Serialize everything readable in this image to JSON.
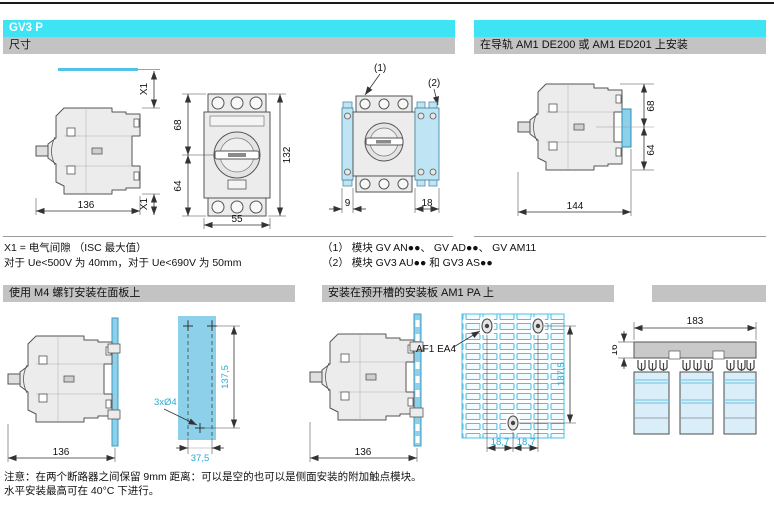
{
  "header": {
    "product": "GV3 P",
    "dim_title": "尺寸",
    "rail_title": "在导轨 AM1 DE200 或 AM1 ED201 上安装"
  },
  "sections": {
    "panel_title": "使用 M4 螺钉安装在面板上",
    "plate_title": "安装在预开槽的安装板 AM1 PA 上"
  },
  "footnotes": {
    "x1_line1": "X1 = 电气间隙 （ISC 最大值）",
    "x1_line2": "对于 Ue<500V 为 40mm，对于 Ue<690V 为 50mm",
    "mod_line1": "（1） 模块 GV AN●●、 GV AD●●、 GV AM11",
    "mod_line2": "（2） 模块 GV3 AU●● 和 GV3 AS●●"
  },
  "notes": {
    "line1": "注意：在两个断路器之间保留 9mm 距离：可以是空的也可以是侧面安装的附加触点模块。",
    "line2": "水平安装最高可在 40°C 下进行。"
  },
  "dims": {
    "side": {
      "x1_top": "X1",
      "x1_bottom": "X1",
      "width": "136"
    },
    "front": {
      "upper": "68",
      "lower": "64",
      "height": "132",
      "width": "55"
    },
    "mod": {
      "c1": "(1)",
      "c2": "(2)",
      "left": "9",
      "right": "18"
    },
    "rail": {
      "upper": "68",
      "lower": "64",
      "width": "144"
    },
    "panel": {
      "width": "136"
    },
    "tpl": {
      "holes": "3xØ4",
      "v": "137,5",
      "h": "37,5"
    },
    "plate": {
      "ref": "AF1 EA4",
      "width": "136"
    },
    "grid": {
      "v": "137,5",
      "h1": "18,7",
      "h2": "18,7"
    },
    "multi": {
      "width": "183",
      "comb": "16"
    }
  },
  "colors": {
    "header_cyan": "#3EE3F4",
    "bar_gray": "#C3C3C3",
    "drawing_cyan": "#8CD0E9",
    "dim_cyan": "#2AA9D2"
  }
}
